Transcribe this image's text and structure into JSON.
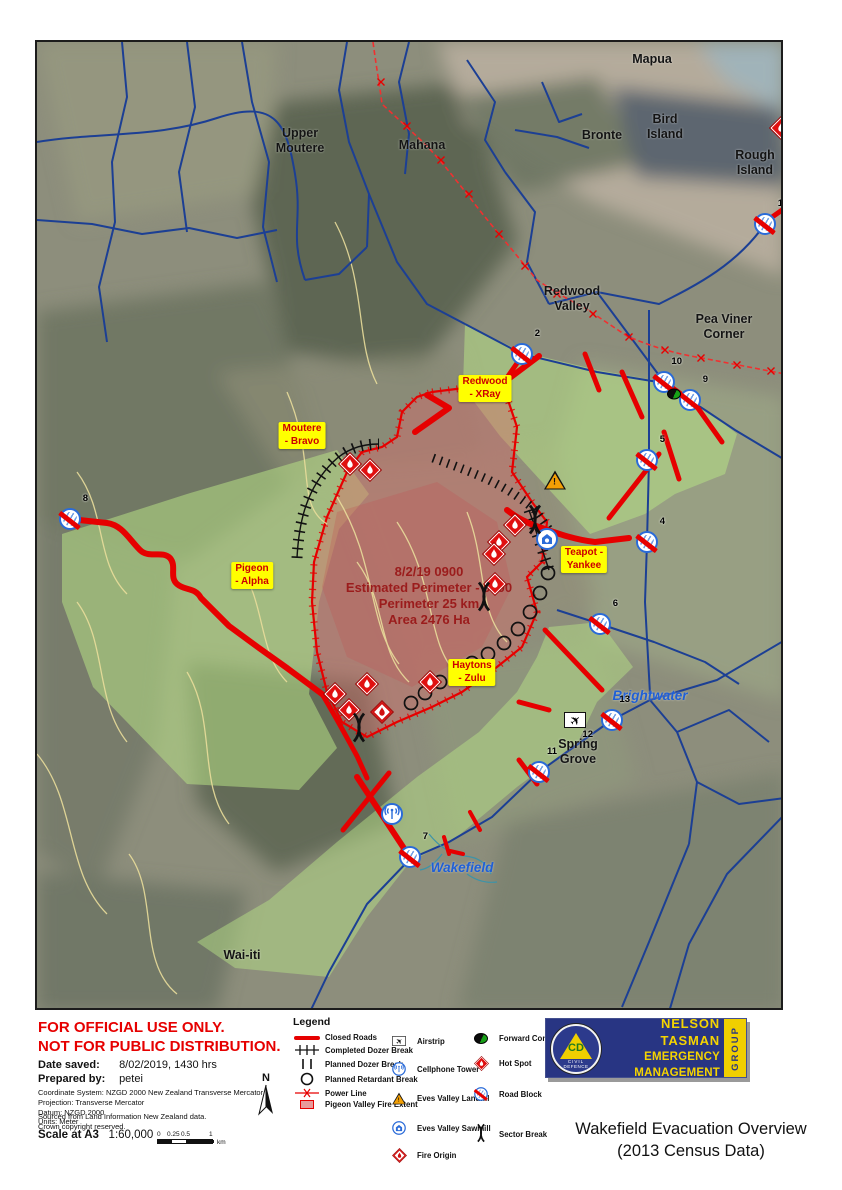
{
  "title": {
    "line1": "Wakefield Evacuation Overview",
    "line2": "(2013 Census Data)"
  },
  "logo": {
    "line1": "NELSON TASMAN",
    "line2": "EMERGENCY MANAGEMENT",
    "group": "GROUP",
    "cd": "CD",
    "civil": "CIVIL",
    "defence": "DEFENCE"
  },
  "info": {
    "classification1": "FOR OFFICIAL USE ONLY.",
    "classification2": "NOT FOR PUBLIC DISTRIBUTION.",
    "date_saved_label": "Date saved:",
    "date_saved": "8/02/2019, 1430 hrs",
    "prepared_by_label": "Prepared by:",
    "prepared_by": "petei",
    "meta": [
      "Coordinate System: NZGD 2000 New Zealand Transverse Mercator",
      "Projection: Transverse Mercator",
      "Datum: NZGD 2000",
      "Units: Meter"
    ],
    "source": [
      "Sourced from Land Information New Zealand data.",
      "Crown copyright reserved."
    ],
    "scale_label": "Scale at A3",
    "scale_value": "1:60,000",
    "scalebar": {
      "labels": [
        "0",
        "0.25",
        "0.5",
        "1"
      ],
      "unit": "km"
    },
    "north": "N"
  },
  "legend": {
    "title": "Legend",
    "col1": [
      {
        "icon": "closed-roads",
        "label": "Closed Roads"
      },
      {
        "icon": "completed-dozer-break",
        "label": "Completed Dozer Break"
      },
      {
        "icon": "planned-dozer-break",
        "label": "Planned Dozer Break"
      },
      {
        "icon": "planned-retardant-break",
        "label": "Planned Retardant Break"
      },
      {
        "icon": "power-line",
        "label": "Power Line"
      },
      {
        "icon": "fire-extent",
        "label": "Pigeon Valley Fire Extent"
      }
    ],
    "col2": [
      {
        "icon": "airstrip",
        "label": "Airstrip"
      },
      {
        "icon": "cellphone-tower",
        "label": "Cellphone Tower"
      },
      {
        "icon": "landfill",
        "label": "Eves Valley Landfill"
      },
      {
        "icon": "sawmill",
        "label": "Eves Valley Sawmill"
      },
      {
        "icon": "fire-origin",
        "label": "Fire Origin"
      }
    ],
    "col3": [
      {
        "icon": "forward-control-point",
        "label": "Forward Control Point"
      },
      {
        "icon": "hot-spot",
        "label": "Hot Spot"
      },
      {
        "icon": "road-block",
        "label": "Road Block"
      },
      {
        "icon": "sector-break",
        "label": "Sector Break"
      }
    ]
  },
  "map": {
    "annotation": {
      "x": 392,
      "y": 522,
      "lines": [
        "8/2/19 0900",
        "Estimated Perimeter - 0900",
        "Perimeter 25 km",
        "Area 2476 Ha"
      ]
    },
    "place_labels": [
      {
        "name": "mapua",
        "lines": [
          "Mapua"
        ],
        "x": 615,
        "y": 10,
        "style": "black"
      },
      {
        "name": "bird-island",
        "lines": [
          "Bird",
          "Island"
        ],
        "x": 628,
        "y": 70,
        "style": "black"
      },
      {
        "name": "bronte",
        "lines": [
          "Bronte"
        ],
        "x": 565,
        "y": 86,
        "style": "black"
      },
      {
        "name": "rough-island",
        "lines": [
          "Rough",
          "Island"
        ],
        "x": 718,
        "y": 106,
        "style": "black"
      },
      {
        "name": "upper-moutere",
        "lines": [
          "Upper",
          "Moutere"
        ],
        "x": 263,
        "y": 84,
        "style": "black"
      },
      {
        "name": "mahana",
        "lines": [
          "Mahana"
        ],
        "x": 385,
        "y": 96,
        "style": "black"
      },
      {
        "name": "redwood-valley",
        "lines": [
          "Redwood",
          "Valley"
        ],
        "x": 535,
        "y": 242,
        "style": "black"
      },
      {
        "name": "pea-viner-corner",
        "lines": [
          "Pea Viner",
          "Corner"
        ],
        "x": 687,
        "y": 270,
        "style": "black"
      },
      {
        "name": "spring-grove",
        "lines": [
          "Spring",
          "Grove"
        ],
        "x": 541,
        "y": 695,
        "style": "black"
      },
      {
        "name": "wai-iti",
        "lines": [
          "Wai-iti"
        ],
        "x": 205,
        "y": 906,
        "style": "black"
      },
      {
        "name": "brightwater",
        "lines": [
          "Brightwater"
        ],
        "x": 613,
        "y": 646,
        "style": "blue"
      },
      {
        "name": "wakefield",
        "lines": [
          "Wakefield"
        ],
        "x": 425,
        "y": 818,
        "style": "blue"
      }
    ],
    "zone_labels": [
      {
        "name": "redwood-xray",
        "lines": [
          "Redwood",
          "- XRay"
        ],
        "x": 448,
        "y": 333
      },
      {
        "name": "moutere-bravo",
        "lines": [
          "Moutere",
          "- Bravo"
        ],
        "x": 265,
        "y": 380
      },
      {
        "name": "pigeon-alpha",
        "lines": [
          "Pigeon",
          "- Alpha"
        ],
        "x": 215,
        "y": 520
      },
      {
        "name": "teapot-yankee",
        "lines": [
          "Teapot -",
          "Yankee"
        ],
        "x": 547,
        "y": 504
      },
      {
        "name": "haytons-zulu",
        "lines": [
          "Haytons",
          "- Zulu"
        ],
        "x": 435,
        "y": 617
      }
    ],
    "roadblocks": [
      {
        "n": "1",
        "x": 728,
        "y": 182
      },
      {
        "n": "2",
        "x": 485,
        "y": 312
      },
      {
        "n": "4",
        "x": 610,
        "y": 500
      },
      {
        "n": "5",
        "x": 610,
        "y": 418
      },
      {
        "n": "6",
        "x": 563,
        "y": 582
      },
      {
        "n": "7",
        "x": 373,
        "y": 815
      },
      {
        "n": "8",
        "x": 33,
        "y": 477
      },
      {
        "n": "9",
        "x": 653,
        "y": 358
      },
      {
        "n": "10",
        "x": 627,
        "y": 340
      },
      {
        "n": "11",
        "x": 502,
        "y": 730
      },
      {
        "n": "13",
        "x": 575,
        "y": 678
      }
    ],
    "airstrip": {
      "n": "12",
      "x": 538,
      "y": 678
    },
    "cell_towers": [
      {
        "x": 355,
        "y": 772
      }
    ],
    "landfill": {
      "x": 518,
      "y": 438
    },
    "sawmill": {
      "x": 510,
      "y": 497
    },
    "forward_control_point": {
      "x": 637,
      "y": 352
    },
    "hot_spots": [
      [
        313,
        422
      ],
      [
        333,
        428
      ],
      [
        478,
        483
      ],
      [
        462,
        500
      ],
      [
        457,
        512
      ],
      [
        458,
        542
      ],
      [
        298,
        652
      ],
      [
        312,
        668
      ],
      [
        330,
        642
      ],
      [
        393,
        640
      ],
      [
        744,
        86
      ]
    ],
    "fire_origin": {
      "x": 345,
      "y": 670
    },
    "sector_breaks": [
      [
        447,
        557
      ],
      [
        322,
        688
      ],
      [
        498,
        480
      ]
    ],
    "colors": {
      "closed_road": "#e60000",
      "road_blue": "#1c3f94",
      "zone_green": "#b6e085",
      "fire_fill": "#d96a6a",
      "label_yellow": "#ffff00",
      "label_red": "#cc0000",
      "annotation_red": "#9b1c1c",
      "logo_navy": "#283583",
      "logo_yellow": "#f0cf00"
    }
  }
}
